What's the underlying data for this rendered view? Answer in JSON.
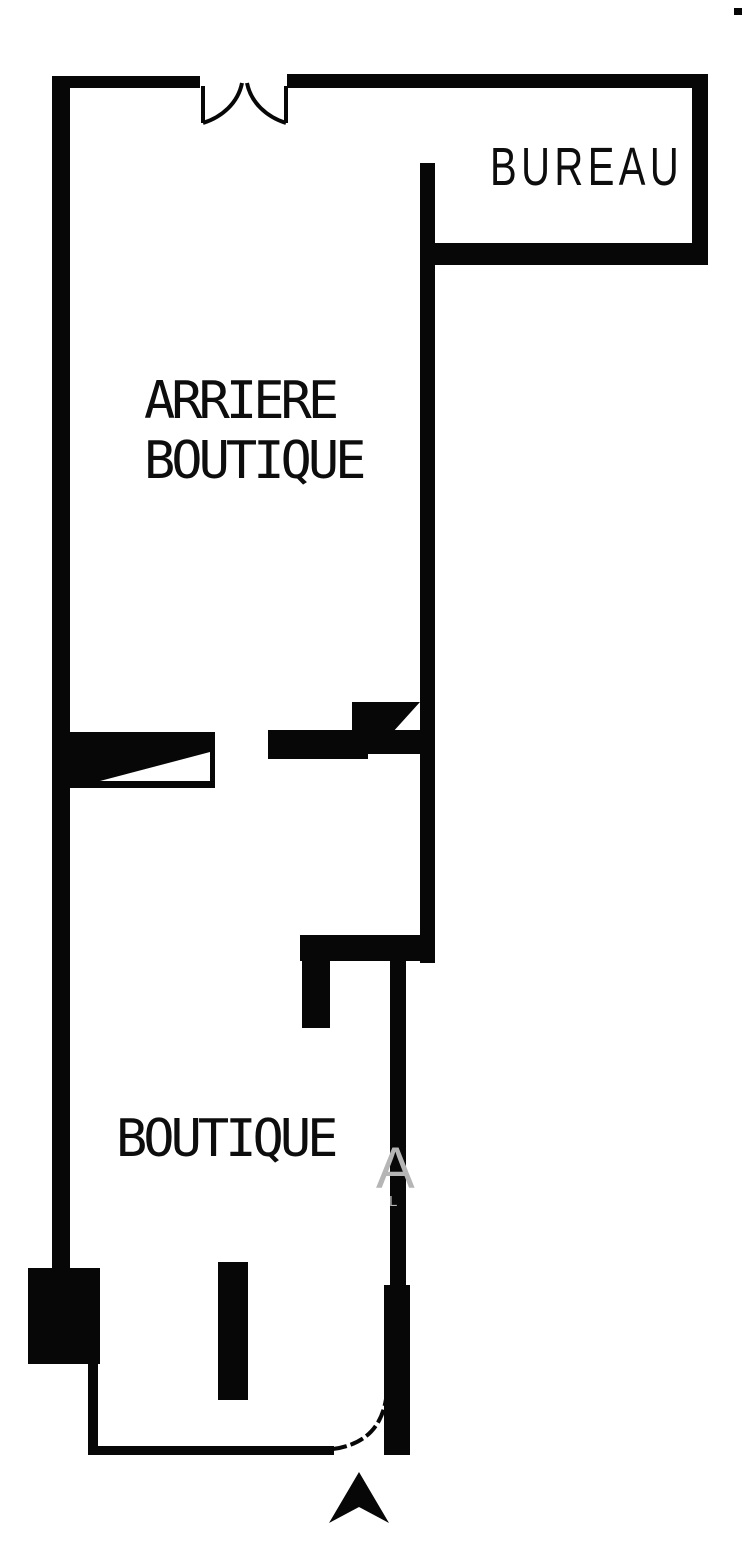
{
  "figure": {
    "type": "floor-plan",
    "background_color": "#ffffff",
    "wall_color": "#070707",
    "watermark_color": "#b5b5b5"
  },
  "rooms": [
    {
      "id": "bureau",
      "label": "BUREAU"
    },
    {
      "id": "arriere-boutique",
      "label_line1": "ARRIERE",
      "label_line2": "BOUTIQUE"
    },
    {
      "id": "boutique",
      "label": "BOUTIQUE"
    }
  ],
  "doors": [
    {
      "id": "top-double-door",
      "type": "double-swing"
    },
    {
      "id": "mid-passage",
      "type": "opening"
    },
    {
      "id": "mid-right-door",
      "type": "swing"
    },
    {
      "id": "left-door",
      "type": "swing"
    },
    {
      "id": "entrance-door",
      "type": "single-swing"
    }
  ],
  "compass": {
    "symbol": "north-arrow"
  },
  "watermark": {
    "letter_large": "A",
    "letter_small": "L"
  }
}
